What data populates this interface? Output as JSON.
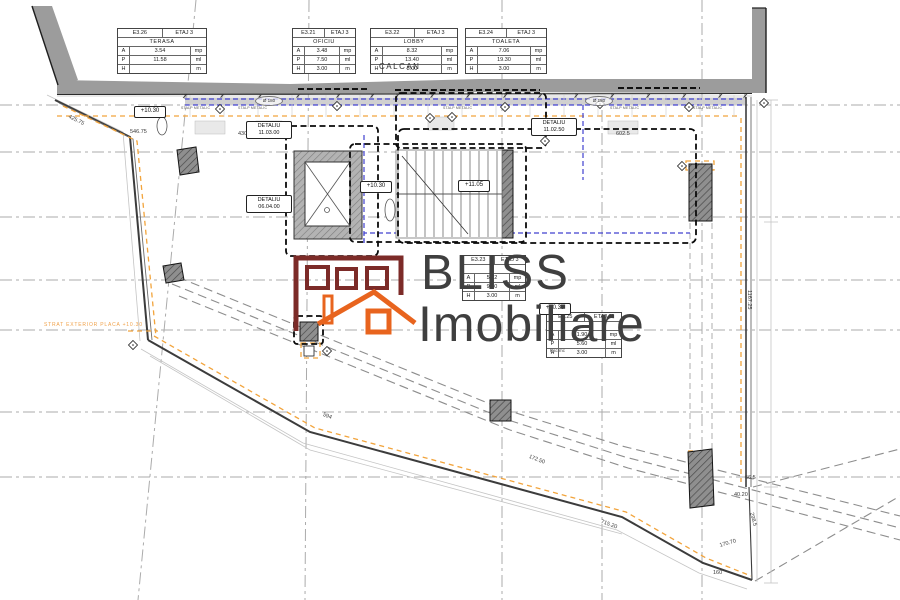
{
  "logo": {
    "line1": "BLISS",
    "line2": "Imobiliare"
  },
  "labels": {
    "calcan": "CALCAN",
    "exterior_note": "STRAT EXTERIOR PLACA +10.30",
    "rsc": "Rsc mc"
  },
  "room_tables": [
    {
      "code": "E3.26",
      "floor": "ETAJ 3",
      "name": "TERASA",
      "rows": [
        {
          "k": "A",
          "v": "3.54",
          "u": "mp"
        },
        {
          "k": "P",
          "v": "11.58",
          "u": "ml"
        },
        {
          "k": "H",
          "v": "",
          "u": "m"
        }
      ]
    },
    {
      "code": "E3.21",
      "floor": "ETAJ 3",
      "name": "OFICIU",
      "rows": [
        {
          "k": "A",
          "v": "3.48",
          "u": "mp"
        },
        {
          "k": "P",
          "v": "7.50",
          "u": "ml"
        },
        {
          "k": "H",
          "v": "3.00",
          "u": "m"
        }
      ]
    },
    {
      "code": "E3.22",
      "floor": "ETAJ 3",
      "name": "LOBBY",
      "rows": [
        {
          "k": "A",
          "v": "8.32",
          "u": "mp"
        },
        {
          "k": "P",
          "v": "13.40",
          "u": "ml"
        },
        {
          "k": "H",
          "v": "3.00",
          "u": "m"
        }
      ]
    },
    {
      "code": "E3.24",
      "floor": "ETAJ 3",
      "name": "TOALETA",
      "rows": [
        {
          "k": "A",
          "v": "7.06",
          "u": "mp"
        },
        {
          "k": "P",
          "v": "19.30",
          "u": "ml"
        },
        {
          "k": "H",
          "v": "3.00",
          "u": "m"
        }
      ]
    },
    {
      "code": "E3.23",
      "floor": "ETAJ 3",
      "name": "",
      "rows": [
        {
          "k": "A",
          "v": "5.22",
          "u": "mp"
        },
        {
          "k": "P",
          "v": "9.40",
          "u": "ml"
        },
        {
          "k": "H",
          "v": "3.00",
          "u": "m"
        }
      ]
    },
    {
      "code": "E3.25",
      "floor": "ETAJ 3",
      "name": "",
      "rows": [
        {
          "k": "A",
          "v": "1.90",
          "u": "mp"
        },
        {
          "k": "P",
          "v": "5.60",
          "u": "ml"
        },
        {
          "k": "H",
          "v": "3.00",
          "u": "m"
        }
      ]
    }
  ],
  "level_markers": [
    {
      "text": "+10.30"
    },
    {
      "text": "+10.30"
    },
    {
      "text": "+11.05"
    },
    {
      "text": "+10.30"
    }
  ],
  "detail_labels": [
    {
      "line1": "DETALIU",
      "line2": "11.03.00"
    },
    {
      "line1": "DETALIU",
      "line2": "06.04.00"
    },
    {
      "line1": "DETALIU",
      "line2": "11.02.50"
    }
  ],
  "dimension_labels": [
    {
      "text": "425.75"
    },
    {
      "text": "546.75"
    },
    {
      "text": "430"
    },
    {
      "text": "602.5"
    },
    {
      "text": "1167.25"
    },
    {
      "text": "594"
    },
    {
      "text": "172.50"
    },
    {
      "text": "715.20"
    },
    {
      "text": "170.70"
    },
    {
      "text": "160"
    },
    {
      "text": "56.5"
    },
    {
      "text": "40.20"
    },
    {
      "text": "298.5"
    }
  ],
  "stalp_labels": [
    {
      "text": "STALP METALIC"
    },
    {
      "text": "STALP METALIC"
    },
    {
      "text": "STALP METALIC"
    },
    {
      "text": "STALP METALIC"
    },
    {
      "text": "STALP METALIC"
    }
  ],
  "diameter_labels": [
    {
      "text": "Ø 180"
    },
    {
      "text": "Ø 180"
    }
  ],
  "colors": {
    "wall_gray": "#9c9c9c",
    "axis_blue": "#4040cf",
    "boundary_orange": "#f2a43c",
    "logo_maroon": "#7c2b28",
    "logo_orange": "#e8641e"
  }
}
